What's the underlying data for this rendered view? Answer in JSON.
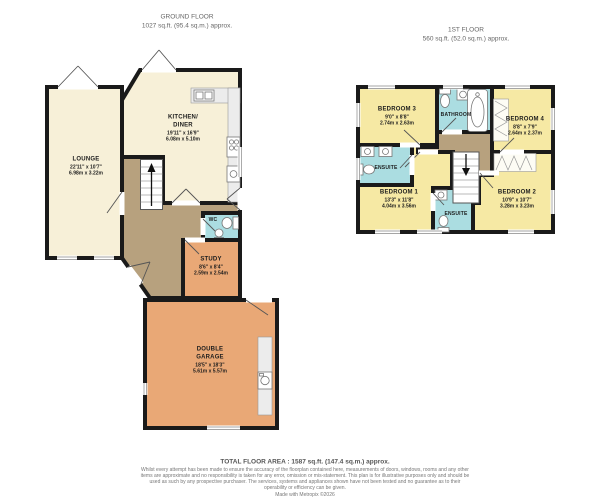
{
  "floors": {
    "ground": {
      "title": "GROUND FLOOR",
      "area": "1027 sq.ft. (95.4 sq.m.) approx."
    },
    "first": {
      "title": "1ST FLOOR",
      "area": "560 sq.ft. (52.0 sq.m.) approx."
    }
  },
  "rooms": {
    "lounge": {
      "name": "LOUNGE",
      "imperial": "22'11\" x 10'7\"",
      "metric": "6.98m x 3.22m"
    },
    "kitchen": {
      "name": "KITCHEN/",
      "name2": "DINER",
      "imperial": "19'11\" x 16'9\"",
      "metric": "6.08m x 5.10m"
    },
    "wc": {
      "name": "WC"
    },
    "study": {
      "name": "STUDY",
      "imperial": "8'6\" x 8'4\"",
      "metric": "2.59m x 2.54m"
    },
    "garage": {
      "name": "DOUBLE",
      "name2": "GARAGE",
      "imperial": "18'5\" x 18'3\"",
      "metric": "5.61m x 5.57m"
    },
    "bedroom3": {
      "name": "BEDROOM 3",
      "imperial": "9'0\" x 8'8\"",
      "metric": "2.74m x 2.63m"
    },
    "bathroom": {
      "name": "BATHROOM"
    },
    "bedroom4": {
      "name": "BEDROOM 4",
      "imperial": "8'8\" x 7'9\"",
      "metric": "2.64m x 2.37m"
    },
    "ensuite1": {
      "name": "ENSUITE"
    },
    "bedroom1": {
      "name": "BEDROOM 1",
      "imperial": "13'3\" x 11'8\"",
      "metric": "4.04m x 3.56m"
    },
    "ensuite2": {
      "name": "ENSUITE"
    },
    "bedroom2": {
      "name": "BEDROOM 2",
      "imperial": "10'9\" x 10'7\"",
      "metric": "3.28m x 3.23m"
    }
  },
  "footer": {
    "total": "TOTAL FLOOR AREA : 1587 sq.ft. (147.4 sq.m.) approx.",
    "disclaimer": "Whilst every attempt has been made to ensure the accuracy of the floorplan contained here, measurements of doors, windows, rooms and any other items are approximate and no responsibility is taken for any error, omission or mis-statement. This plan is for illustrative purposes only and should be used as such by any prospective purchaser. The services, systems and appliances shown have not been tested and no guarantee as to their operability or efficiency can be given.",
    "credit": "Made with Metropix ©2026"
  },
  "colors": {
    "wall": "#1a1a1a",
    "cream": "#f7f0d8",
    "yellow": "#f6e9a4",
    "orange": "#e9a876",
    "brown": "#b7a17e",
    "teal": "#abdde1"
  }
}
